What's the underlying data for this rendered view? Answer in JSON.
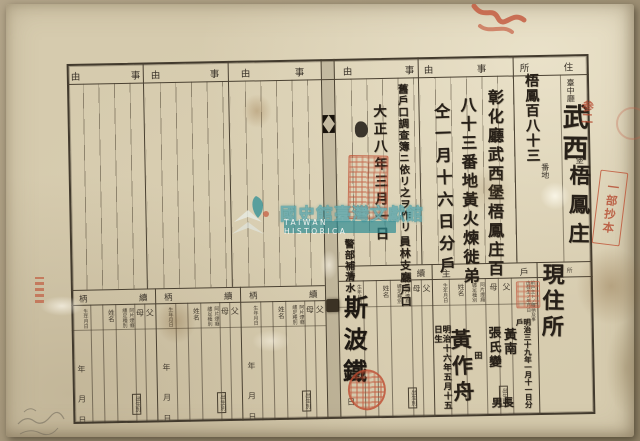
{
  "watermark": {
    "org_zh": "國史館臺灣文獻館",
    "org_en": "TAIWAN HISTORICA",
    "accent_color": "#2e8f96"
  },
  "header_chars": {
    "ji": "事",
    "yu": "由",
    "ju": "住",
    "sho": "所",
    "ko": "戶",
    "shu": "主",
    "zoku": "續",
    "gara": "柄"
  },
  "address": {
    "prefecture": "臺中廳",
    "district_hand": "武西",
    "district_suffix": "堡",
    "village_hand": "梧鳳庄",
    "lot_hand": "梧鳳百八十三",
    "lot_unit": "番地"
  },
  "person_labels": {
    "father": "父",
    "mother": "母",
    "type_a": "阿片煙癮",
    "type_b": "纏足種別",
    "name": "姓名",
    "birth_order": "出生別",
    "birth_date": "生年月日",
    "year": "年",
    "month": "月",
    "day": "日",
    "pre_head": "前戶主トノ續柄及事由發生ノ年月日"
  },
  "entries": {
    "current_address": "現住所",
    "jiyu_line1": "彰化廳武西堡梧鳳庄百",
    "jiyu_line2": "八十三番地黃火煉徙弟",
    "jiyu_line3": "仝一月十六日分戶",
    "record_note": "舊戶口調查簿ニ依リ之ヲ作リ",
    "record_date": "大正八年三月一日",
    "record_office": "員林支廳戶口",
    "record_official": "警部補清水",
    "head_note": "明治三十九年一月十一日分戶",
    "head_father": "黃南",
    "head_mother": "張氏變",
    "head_birth_order": "長男",
    "head_name": "黃作舟",
    "head_name_note": "田",
    "head_birth_date": "明治十六年五月十五日生",
    "clerk_signature": "斯波鐵"
  },
  "stamps": {
    "excerpt_stamp": "一部抄本",
    "red_script": "参二"
  }
}
